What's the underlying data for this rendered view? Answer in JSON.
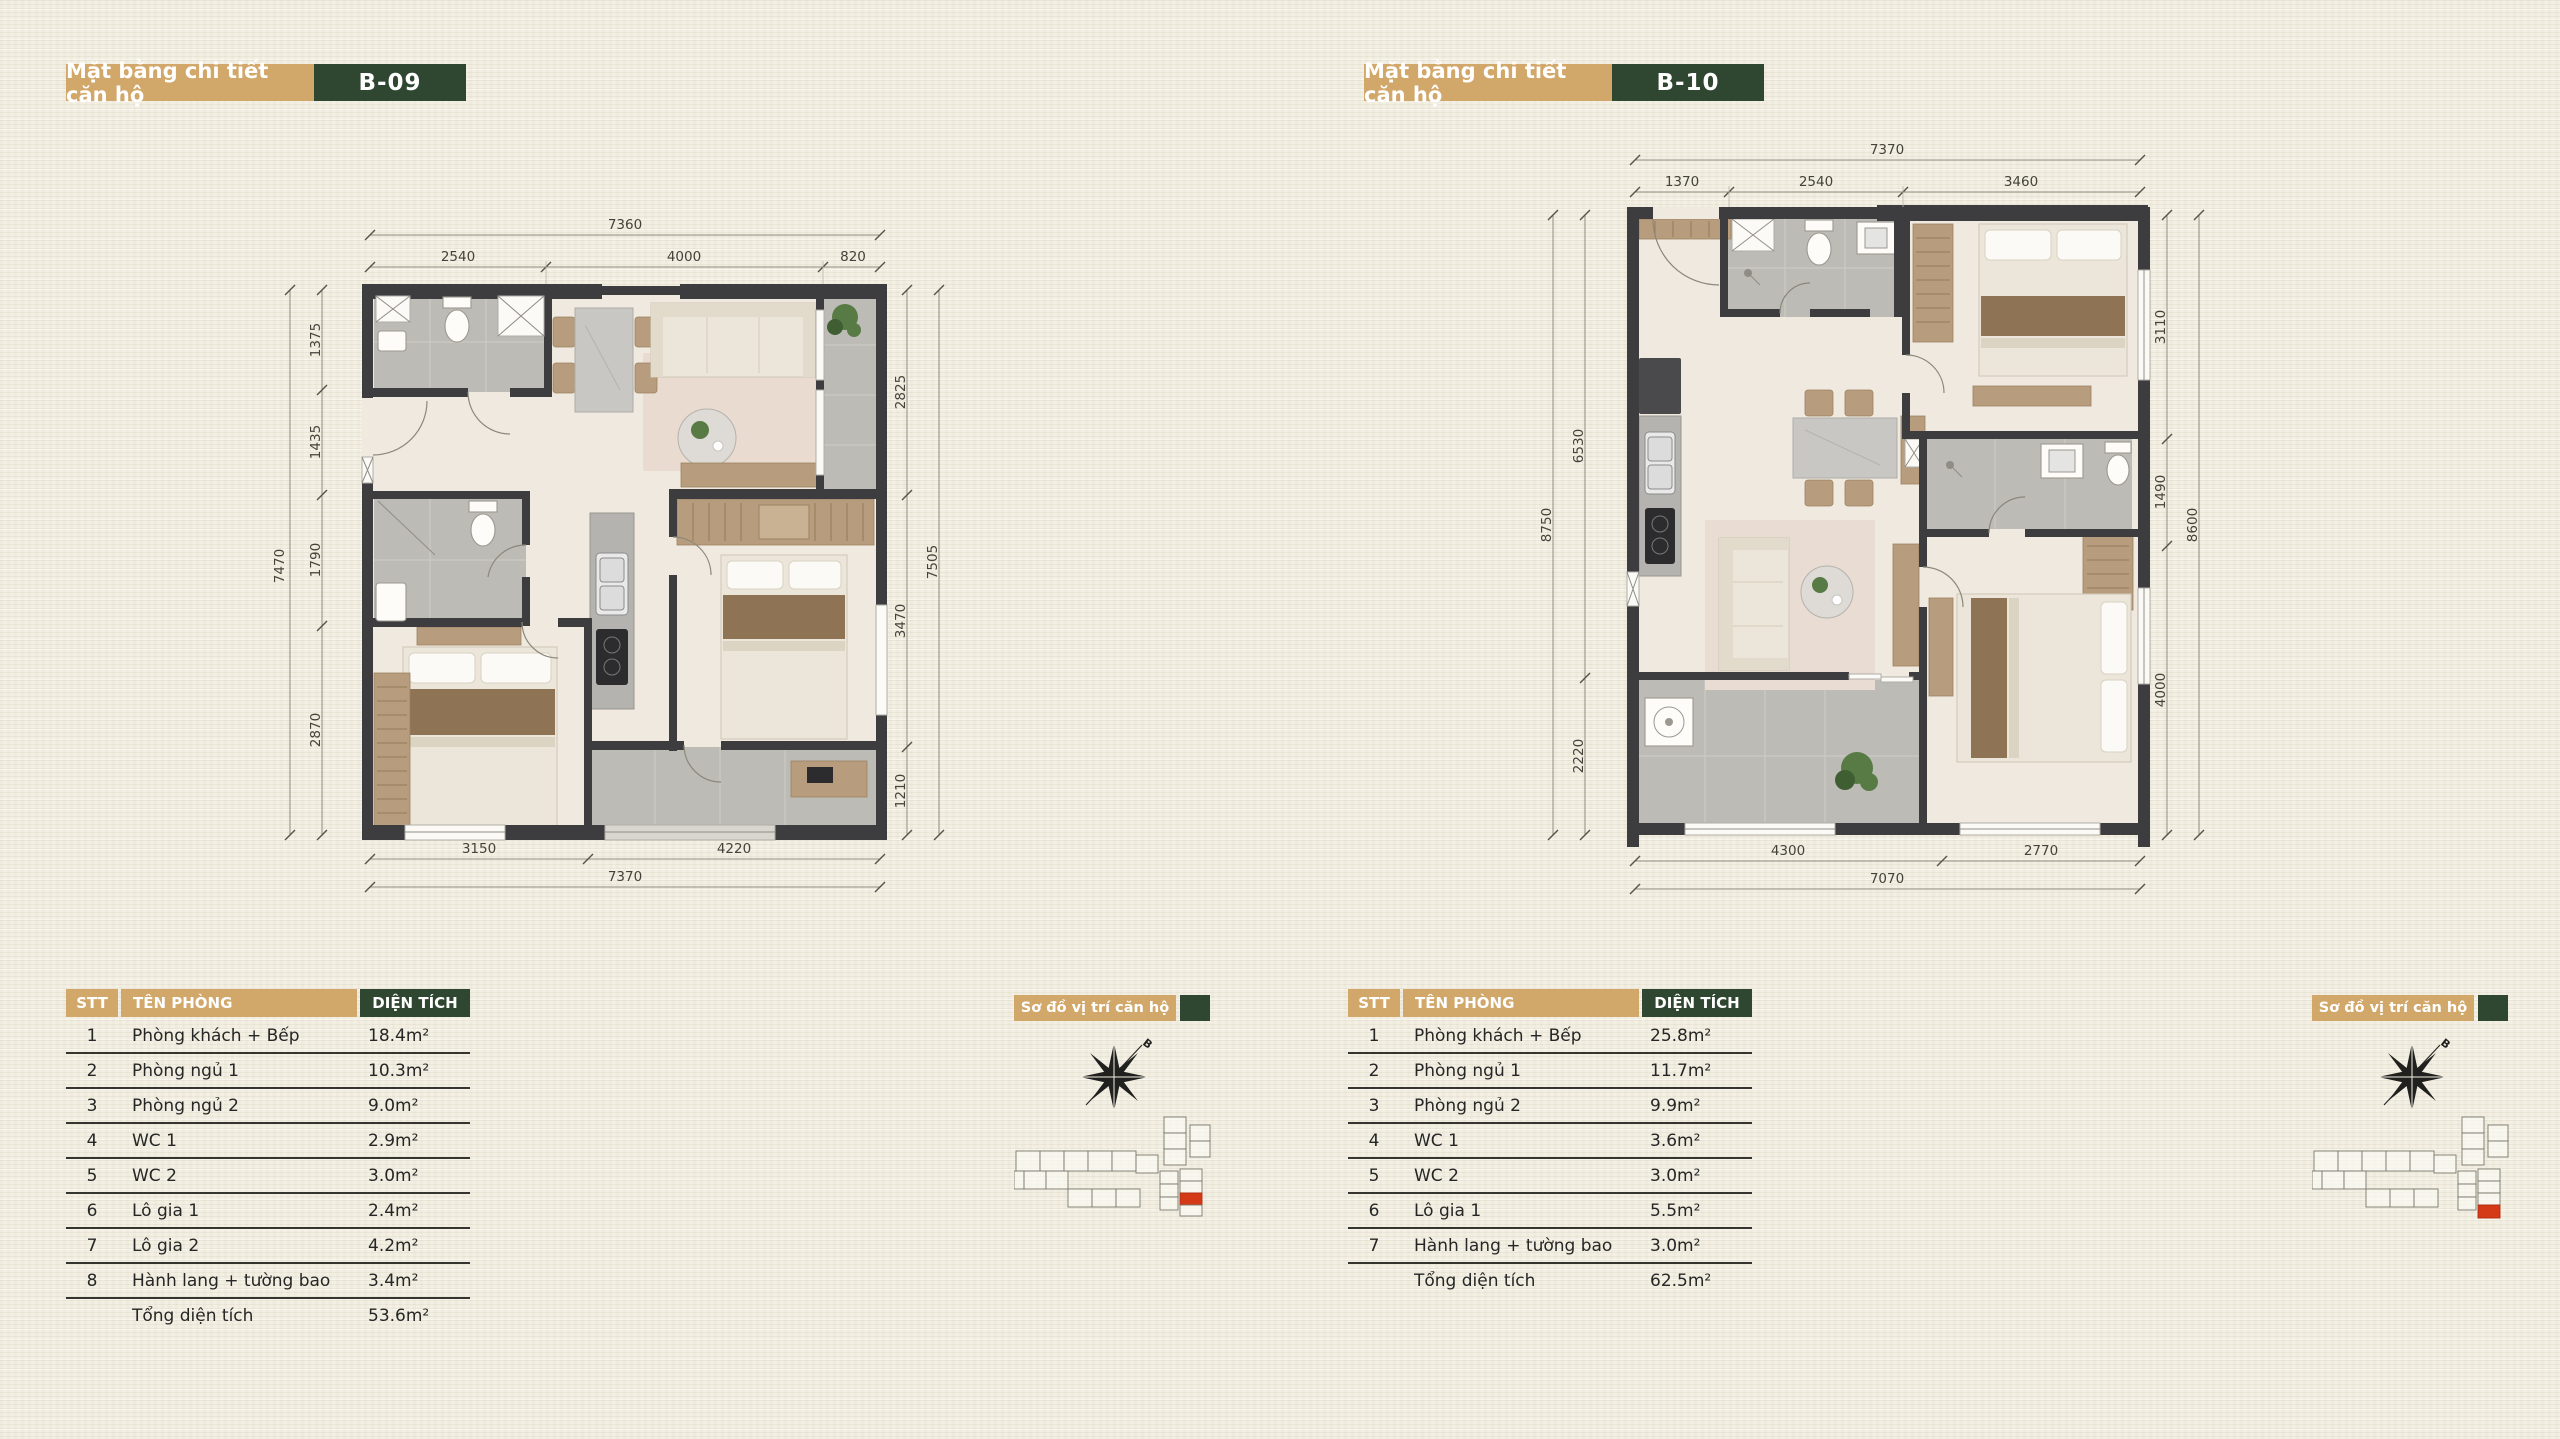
{
  "colors": {
    "tan": "#d2a76a",
    "dark_green": "#2f4730",
    "red_highlight": "#d43a17",
    "paper": "#f3efe2",
    "wall": "#3d3d40",
    "tile_gray": "#bdbbb6",
    "wood": "#b79c7d"
  },
  "plans": [
    {
      "title": "Mặt bằng chi tiết căn hộ",
      "unit": "B-09",
      "dims": {
        "top_overall": "7360",
        "top": [
          "2540",
          "4000",
          "820"
        ],
        "left_overall": "7470",
        "left": [
          "1375",
          "1435",
          "1790",
          "2870"
        ],
        "right_overall": "7505",
        "right": [
          "2825",
          "3470",
          "1210"
        ],
        "bottom_overall": "7370",
        "bottom": [
          "3150",
          "4220"
        ]
      },
      "table": {
        "headers": [
          "STT",
          "TÊN PHÒNG",
          "DIỆN TÍCH"
        ],
        "rows": [
          [
            "1",
            "Phòng khách + Bếp",
            "18.4m²"
          ],
          [
            "2",
            "Phòng ngủ 1",
            "10.3m²"
          ],
          [
            "3",
            "Phòng ngủ 2",
            "9.0m²"
          ],
          [
            "4",
            "WC 1",
            "2.9m²"
          ],
          [
            "5",
            "WC 2",
            "3.0m²"
          ],
          [
            "6",
            "Lô gia 1",
            "2.4m²"
          ],
          [
            "7",
            "Lô gia 2",
            "4.2m²"
          ],
          [
            "8",
            "Hành lang + tường bao",
            "3.4m²"
          ]
        ],
        "total_label": "Tổng diện tích",
        "total_value": "53.6m²"
      },
      "location": {
        "title": "Sơ đồ vị trí căn hộ",
        "compass_label": "B"
      }
    },
    {
      "title": "Mặt bằng chi tiết căn hộ",
      "unit": "B-10",
      "dims": {
        "top_overall": "7370",
        "top": [
          "1370",
          "2540",
          "3460"
        ],
        "left_overall": "8750",
        "left": [
          "6530",
          "2220"
        ],
        "right_overall": "8600",
        "right": [
          "3110",
          "1490",
          "4000"
        ],
        "bottom_overall": "7070",
        "bottom": [
          "4300",
          "2770"
        ]
      },
      "table": {
        "headers": [
          "STT",
          "TÊN PHÒNG",
          "DIỆN TÍCH"
        ],
        "rows": [
          [
            "1",
            "Phòng khách + Bếp",
            "25.8m²"
          ],
          [
            "2",
            "Phòng ngủ 1",
            "11.7m²"
          ],
          [
            "3",
            "Phòng ngủ 2",
            "9.9m²"
          ],
          [
            "4",
            "WC 1",
            "3.6m²"
          ],
          [
            "5",
            "WC 2",
            "3.0m²"
          ],
          [
            "6",
            "Lô gia 1",
            "5.5m²"
          ],
          [
            "7",
            "Hành lang + tường bao",
            "3.0m²"
          ]
        ],
        "total_label": "Tổng diện tích",
        "total_value": "62.5m²"
      },
      "location": {
        "title": "Sơ đồ vị trí căn hộ",
        "compass_label": "B"
      }
    }
  ]
}
